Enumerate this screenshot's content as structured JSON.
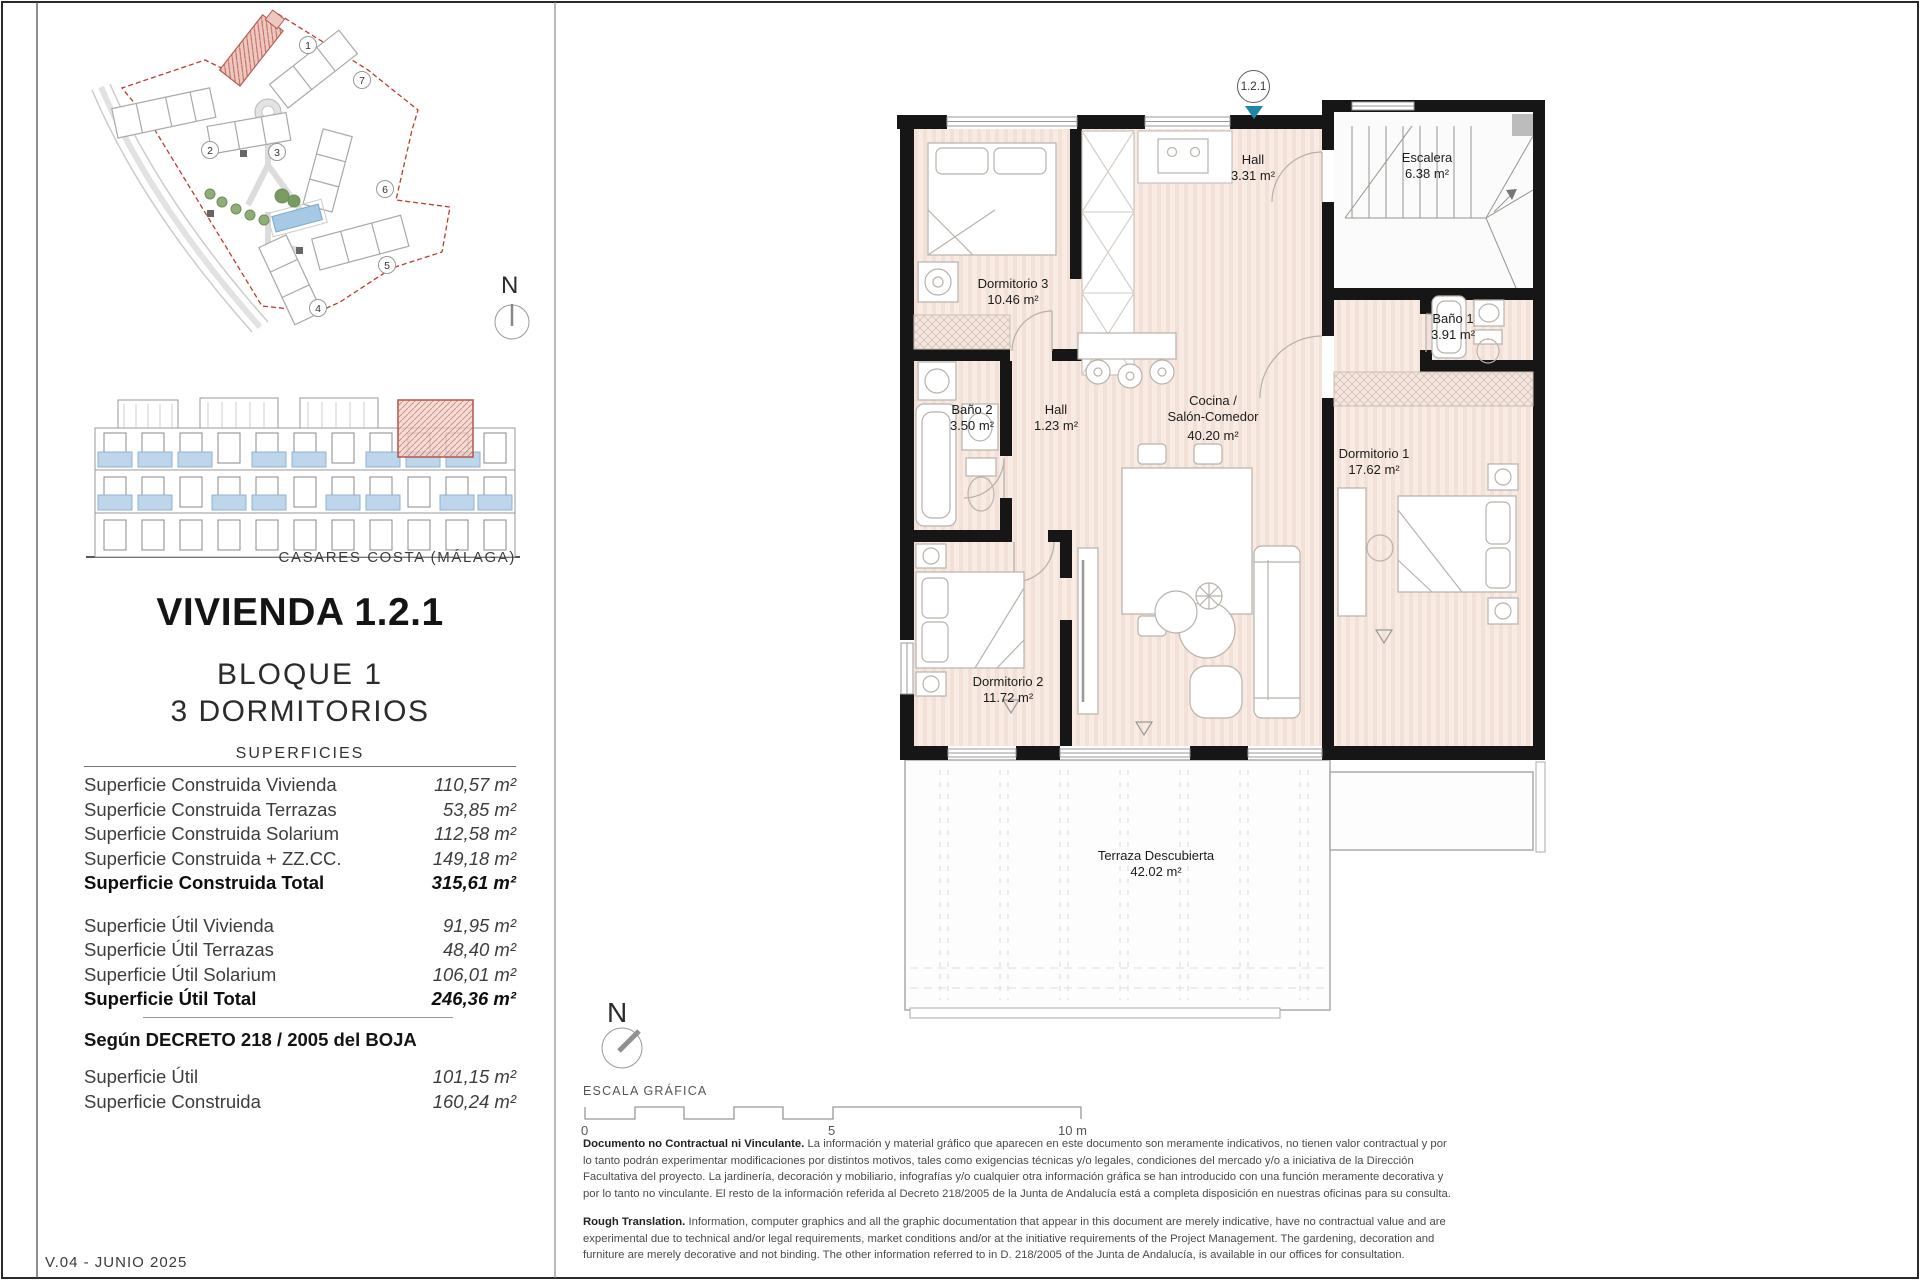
{
  "colors": {
    "marker_teal": "#1e89a4",
    "highlight_red": "#b55c50",
    "balcony_blue": "#bdd6eb",
    "room_fill": "#f8ebe3",
    "boundary_red": "#c0392b",
    "wall_black": "#161616"
  },
  "site_plan": {
    "north_label": "N",
    "building_numbers": [
      "1",
      "2",
      "3",
      "4",
      "5",
      "6",
      "7"
    ]
  },
  "location": {
    "label": "CASARES COSTA (MÁLAGA)"
  },
  "unit": {
    "marker": "1.2.1",
    "title": "VIVIENDA 1.2.1",
    "block": "BLOQUE 1",
    "bedrooms": "3 DORMITORIOS"
  },
  "surfaces": {
    "heading": "SUPERFICIES",
    "rows": [
      {
        "label": "Superficie Construida Vivienda",
        "value": "110,57 m²"
      },
      {
        "label": "Superficie Construida Terrazas",
        "value": "53,85 m²"
      },
      {
        "label": "Superficie Construida Solarium",
        "value": "112,58 m²"
      },
      {
        "label": "Superficie Construida + ZZ.CC.",
        "value": "149,18 m²"
      }
    ],
    "total": {
      "label": "Superficie Construida Total",
      "value": "315,61 m²"
    },
    "util_rows": [
      {
        "label": "Superficie Útil Vivienda",
        "value": "91,95 m²"
      },
      {
        "label": "Superficie Útil Terrazas",
        "value": "48,40 m²"
      },
      {
        "label": "Superficie Útil Solarium",
        "value": "106,01 m²"
      }
    ],
    "util_total": {
      "label": "Superficie Útil Total",
      "value": "246,36 m²"
    },
    "decreto_heading": "Según DECRETO 218 / 2005 del BOJA",
    "decreto_rows": [
      {
        "label": "Superficie Útil",
        "value": "101,15 m²"
      },
      {
        "label": "Superficie Construida",
        "value": "160,24 m²"
      }
    ]
  },
  "floor_plan": {
    "north_label": "N",
    "rooms": {
      "dormitorio3": {
        "name": "Dormitorio 3",
        "area": "10.46 m²"
      },
      "hall_top": {
        "name": "Hall",
        "area": "3.31 m²"
      },
      "escalera": {
        "name": "Escalera",
        "area": "6.38 m²"
      },
      "bano1": {
        "name": "Baño 1",
        "area": "3.91 m²"
      },
      "bano2": {
        "name": "Baño 2",
        "area": "3.50 m²"
      },
      "hall": {
        "name": "Hall",
        "area": "1.23 m²"
      },
      "cocina": {
        "name": "Cocina /",
        "name2": "Salón-Comedor",
        "area": "40.20 m²"
      },
      "dormitorio1": {
        "name": "Dormitorio 1",
        "area": "17.62 m²"
      },
      "dormitorio2": {
        "name": "Dormitorio 2",
        "area": "11.72 m²"
      },
      "terraza": {
        "name": "Terraza Descubierta",
        "area": "42.02 m²"
      }
    }
  },
  "scale_bar": {
    "heading": "ESCALA GRÁFICA",
    "t0": "0",
    "t5": "5",
    "t10": "10 m"
  },
  "disclaimer": {
    "es_lead": "Documento no Contractual ni Vinculante.",
    "es_body": " La información y material gráfico que aparecen en este documento son meramente indicativos, no tienen valor contractual y por lo tanto podrán experimentar modificaciones por distintos motivos, tales como exigencias técnicas y/o legales, condiciones del mercado y/o a iniciativa de la Dirección Facultativa del proyecto. La jardinería, decoración y mobiliario, infografías y/o cualquier otra información gráfica se han introducido con una función meramente decorativa y por lo tanto no vinculante. El resto de la información referida al Decreto 218/2005 de la Junta de Andalucía está a completa disposición en nuestras oficinas para su consulta.",
    "en_lead": "Rough Translation.",
    "en_body": " Information, computer graphics and all the graphic documentation that appear in this document are merely indicative, have no contractual value and are experimental due to technical and/or legal requirements, market conditions and/or at the initiative requirements of the Project Management. The gardening, decoration and furniture are merely decorative and not binding. The other information referred to in D. 218/2005 of the Junta de Andalucía, is available in our offices for consultation."
  },
  "version": {
    "label": "V.04 - JUNIO 2025"
  }
}
